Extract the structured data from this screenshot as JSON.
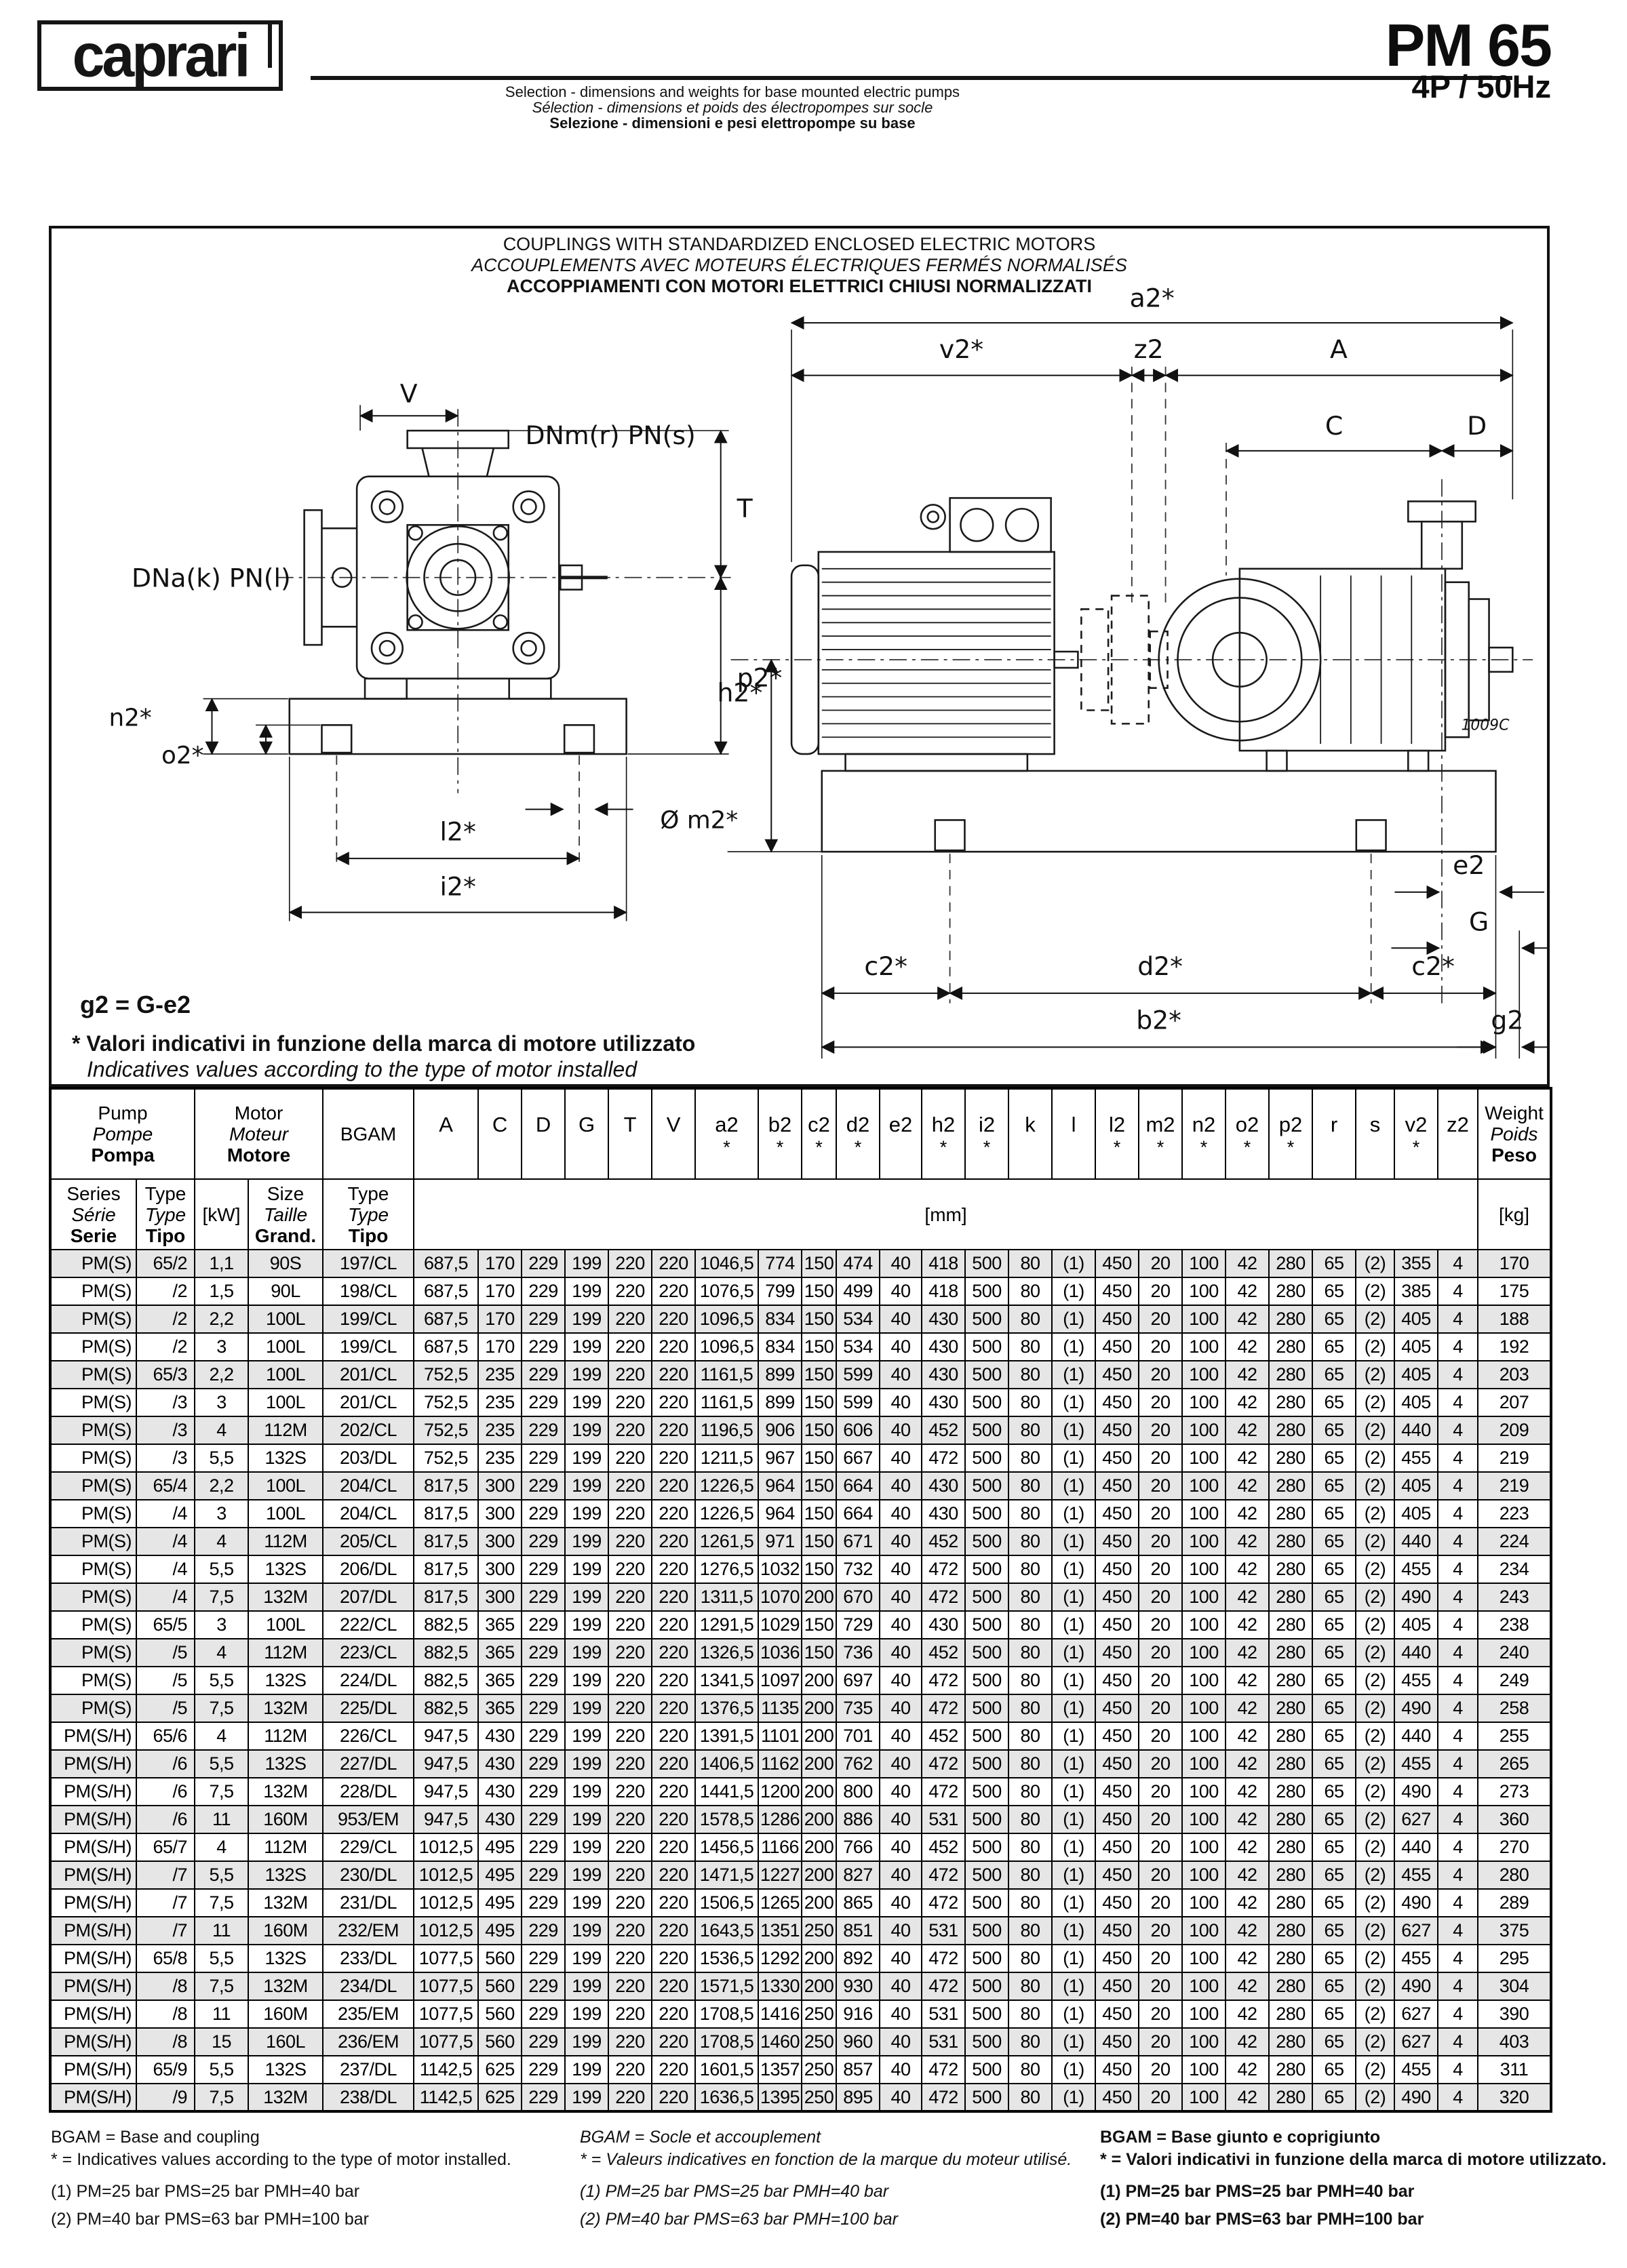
{
  "header": {
    "logo": "caprari",
    "subtitle_lines": {
      "en": "Selection - dimensions and weights for base mounted electric pumps",
      "fr": "Sélection - dimensions et poids des électropompes sur socle",
      "it": "Selezione - dimensioni e pesi elettropompe su base"
    },
    "model": "PM 65",
    "spec": "4P / 50Hz"
  },
  "diagram": {
    "title_lines": {
      "en": "COUPLINGS WITH STANDARDIZED ENCLOSED ELECTRIC MOTORS",
      "fr": "ACCOUPLEMENTS AVEC MOTEURS ÉLECTRIQUES FERMÉS NORMALISÉS",
      "it": "ACCOPPIAMENTI CON MOTORI ELETTRICI CHIUSI NORMALIZZATI"
    },
    "note_g2": "g2 = G-e2",
    "note_star_it": "* Valori indicativi in funzione della marca di motore utilizzato",
    "note_star_en": "Indicatives values according to the type of motor installed",
    "labels": {
      "v": "V",
      "dnm": "DNm(r) PN(s)",
      "t": "T",
      "dna": "DNa(k) PN(l)",
      "p2": "p2*",
      "n2": "n2*",
      "o2": "o2*",
      "m2": "Ø m2*",
      "l2": "l2*",
      "i2": "i2*",
      "a2": "a2*",
      "v2": "v2*",
      "z2": "z2",
      "A": "A",
      "C": "C",
      "D": "D",
      "h2": "h2*",
      "e2": "e2",
      "G": "G",
      "c2_left": "c2*",
      "d2": "d2*",
      "c2_right": "c2*",
      "b2": "b2*",
      "g2": "g2",
      "ref_code": "1009C"
    }
  },
  "table": {
    "groups": {
      "pump": [
        "Pump",
        "Pompe",
        "Pompa"
      ],
      "motor": [
        "Motor",
        "Moteur",
        "Motore"
      ],
      "bgam": "BGAM",
      "weight": [
        "Weight",
        "Poids",
        "Peso"
      ]
    },
    "subheaders": {
      "series": [
        "Series",
        "Série",
        "Serie"
      ],
      "type": [
        "Type",
        "Type",
        "Tipo"
      ],
      "kw": "[kW]",
      "size": [
        "Size",
        "Taille",
        "Grand."
      ],
      "bgam_type": [
        "Type",
        "Type",
        "Tipo"
      ],
      "mm": "[mm]",
      "kg": "[kg]"
    },
    "dim_columns": [
      {
        "label": "A",
        "star": false
      },
      {
        "label": "C",
        "star": false
      },
      {
        "label": "D",
        "star": false
      },
      {
        "label": "G",
        "star": false
      },
      {
        "label": "T",
        "star": false
      },
      {
        "label": "V",
        "star": false
      },
      {
        "label": "a2",
        "star": true
      },
      {
        "label": "b2",
        "star": true
      },
      {
        "label": "c2",
        "star": true
      },
      {
        "label": "d2",
        "star": true
      },
      {
        "label": "e2",
        "star": false
      },
      {
        "label": "h2",
        "star": true
      },
      {
        "label": "i2",
        "star": true
      },
      {
        "label": "k",
        "star": false
      },
      {
        "label": "l",
        "star": false
      },
      {
        "label": "l2",
        "star": true
      },
      {
        "label": "m2",
        "star": true
      },
      {
        "label": "n2",
        "star": true
      },
      {
        "label": "o2",
        "star": true
      },
      {
        "label": "p2",
        "star": true
      },
      {
        "label": "r",
        "star": false
      },
      {
        "label": "s",
        "star": false
      },
      {
        "label": "v2",
        "star": true
      },
      {
        "label": "z2",
        "star": false
      }
    ],
    "rows": [
      [
        "PM(S)",
        "65/2",
        "1,1",
        "90S",
        "197/CL",
        "687,5",
        "170",
        "229",
        "199",
        "220",
        "220",
        "1046,5",
        "774",
        "150",
        "474",
        "40",
        "418",
        "500",
        "80",
        "(1)",
        "450",
        "20",
        "100",
        "42",
        "280",
        "65",
        "(2)",
        "355",
        "4",
        "170"
      ],
      [
        "PM(S)",
        "/2",
        "1,5",
        "90L",
        "198/CL",
        "687,5",
        "170",
        "229",
        "199",
        "220",
        "220",
        "1076,5",
        "799",
        "150",
        "499",
        "40",
        "418",
        "500",
        "80",
        "(1)",
        "450",
        "20",
        "100",
        "42",
        "280",
        "65",
        "(2)",
        "385",
        "4",
        "175"
      ],
      [
        "PM(S)",
        "/2",
        "2,2",
        "100L",
        "199/CL",
        "687,5",
        "170",
        "229",
        "199",
        "220",
        "220",
        "1096,5",
        "834",
        "150",
        "534",
        "40",
        "430",
        "500",
        "80",
        "(1)",
        "450",
        "20",
        "100",
        "42",
        "280",
        "65",
        "(2)",
        "405",
        "4",
        "188"
      ],
      [
        "PM(S)",
        "/2",
        "3",
        "100L",
        "199/CL",
        "687,5",
        "170",
        "229",
        "199",
        "220",
        "220",
        "1096,5",
        "834",
        "150",
        "534",
        "40",
        "430",
        "500",
        "80",
        "(1)",
        "450",
        "20",
        "100",
        "42",
        "280",
        "65",
        "(2)",
        "405",
        "4",
        "192"
      ],
      [
        "PM(S)",
        "65/3",
        "2,2",
        "100L",
        "201/CL",
        "752,5",
        "235",
        "229",
        "199",
        "220",
        "220",
        "1161,5",
        "899",
        "150",
        "599",
        "40",
        "430",
        "500",
        "80",
        "(1)",
        "450",
        "20",
        "100",
        "42",
        "280",
        "65",
        "(2)",
        "405",
        "4",
        "203"
      ],
      [
        "PM(S)",
        "/3",
        "3",
        "100L",
        "201/CL",
        "752,5",
        "235",
        "229",
        "199",
        "220",
        "220",
        "1161,5",
        "899",
        "150",
        "599",
        "40",
        "430",
        "500",
        "80",
        "(1)",
        "450",
        "20",
        "100",
        "42",
        "280",
        "65",
        "(2)",
        "405",
        "4",
        "207"
      ],
      [
        "PM(S)",
        "/3",
        "4",
        "112M",
        "202/CL",
        "752,5",
        "235",
        "229",
        "199",
        "220",
        "220",
        "1196,5",
        "906",
        "150",
        "606",
        "40",
        "452",
        "500",
        "80",
        "(1)",
        "450",
        "20",
        "100",
        "42",
        "280",
        "65",
        "(2)",
        "440",
        "4",
        "209"
      ],
      [
        "PM(S)",
        "/3",
        "5,5",
        "132S",
        "203/DL",
        "752,5",
        "235",
        "229",
        "199",
        "220",
        "220",
        "1211,5",
        "967",
        "150",
        "667",
        "40",
        "472",
        "500",
        "80",
        "(1)",
        "450",
        "20",
        "100",
        "42",
        "280",
        "65",
        "(2)",
        "455",
        "4",
        "219"
      ],
      [
        "PM(S)",
        "65/4",
        "2,2",
        "100L",
        "204/CL",
        "817,5",
        "300",
        "229",
        "199",
        "220",
        "220",
        "1226,5",
        "964",
        "150",
        "664",
        "40",
        "430",
        "500",
        "80",
        "(1)",
        "450",
        "20",
        "100",
        "42",
        "280",
        "65",
        "(2)",
        "405",
        "4",
        "219"
      ],
      [
        "PM(S)",
        "/4",
        "3",
        "100L",
        "204/CL",
        "817,5",
        "300",
        "229",
        "199",
        "220",
        "220",
        "1226,5",
        "964",
        "150",
        "664",
        "40",
        "430",
        "500",
        "80",
        "(1)",
        "450",
        "20",
        "100",
        "42",
        "280",
        "65",
        "(2)",
        "405",
        "4",
        "223"
      ],
      [
        "PM(S)",
        "/4",
        "4",
        "112M",
        "205/CL",
        "817,5",
        "300",
        "229",
        "199",
        "220",
        "220",
        "1261,5",
        "971",
        "150",
        "671",
        "40",
        "452",
        "500",
        "80",
        "(1)",
        "450",
        "20",
        "100",
        "42",
        "280",
        "65",
        "(2)",
        "440",
        "4",
        "224"
      ],
      [
        "PM(S)",
        "/4",
        "5,5",
        "132S",
        "206/DL",
        "817,5",
        "300",
        "229",
        "199",
        "220",
        "220",
        "1276,5",
        "1032",
        "150",
        "732",
        "40",
        "472",
        "500",
        "80",
        "(1)",
        "450",
        "20",
        "100",
        "42",
        "280",
        "65",
        "(2)",
        "455",
        "4",
        "234"
      ],
      [
        "PM(S)",
        "/4",
        "7,5",
        "132M",
        "207/DL",
        "817,5",
        "300",
        "229",
        "199",
        "220",
        "220",
        "1311,5",
        "1070",
        "200",
        "670",
        "40",
        "472",
        "500",
        "80",
        "(1)",
        "450",
        "20",
        "100",
        "42",
        "280",
        "65",
        "(2)",
        "490",
        "4",
        "243"
      ],
      [
        "PM(S)",
        "65/5",
        "3",
        "100L",
        "222/CL",
        "882,5",
        "365",
        "229",
        "199",
        "220",
        "220",
        "1291,5",
        "1029",
        "150",
        "729",
        "40",
        "430",
        "500",
        "80",
        "(1)",
        "450",
        "20",
        "100",
        "42",
        "280",
        "65",
        "(2)",
        "405",
        "4",
        "238"
      ],
      [
        "PM(S)",
        "/5",
        "4",
        "112M",
        "223/CL",
        "882,5",
        "365",
        "229",
        "199",
        "220",
        "220",
        "1326,5",
        "1036",
        "150",
        "736",
        "40",
        "452",
        "500",
        "80",
        "(1)",
        "450",
        "20",
        "100",
        "42",
        "280",
        "65",
        "(2)",
        "440",
        "4",
        "240"
      ],
      [
        "PM(S)",
        "/5",
        "5,5",
        "132S",
        "224/DL",
        "882,5",
        "365",
        "229",
        "199",
        "220",
        "220",
        "1341,5",
        "1097",
        "200",
        "697",
        "40",
        "472",
        "500",
        "80",
        "(1)",
        "450",
        "20",
        "100",
        "42",
        "280",
        "65",
        "(2)",
        "455",
        "4",
        "249"
      ],
      [
        "PM(S)",
        "/5",
        "7,5",
        "132M",
        "225/DL",
        "882,5",
        "365",
        "229",
        "199",
        "220",
        "220",
        "1376,5",
        "1135",
        "200",
        "735",
        "40",
        "472",
        "500",
        "80",
        "(1)",
        "450",
        "20",
        "100",
        "42",
        "280",
        "65",
        "(2)",
        "490",
        "4",
        "258"
      ],
      [
        "PM(S/H)",
        "65/6",
        "4",
        "112M",
        "226/CL",
        "947,5",
        "430",
        "229",
        "199",
        "220",
        "220",
        "1391,5",
        "1101",
        "200",
        "701",
        "40",
        "452",
        "500",
        "80",
        "(1)",
        "450",
        "20",
        "100",
        "42",
        "280",
        "65",
        "(2)",
        "440",
        "4",
        "255"
      ],
      [
        "PM(S/H)",
        "/6",
        "5,5",
        "132S",
        "227/DL",
        "947,5",
        "430",
        "229",
        "199",
        "220",
        "220",
        "1406,5",
        "1162",
        "200",
        "762",
        "40",
        "472",
        "500",
        "80",
        "(1)",
        "450",
        "20",
        "100",
        "42",
        "280",
        "65",
        "(2)",
        "455",
        "4",
        "265"
      ],
      [
        "PM(S/H)",
        "/6",
        "7,5",
        "132M",
        "228/DL",
        "947,5",
        "430",
        "229",
        "199",
        "220",
        "220",
        "1441,5",
        "1200",
        "200",
        "800",
        "40",
        "472",
        "500",
        "80",
        "(1)",
        "450",
        "20",
        "100",
        "42",
        "280",
        "65",
        "(2)",
        "490",
        "4",
        "273"
      ],
      [
        "PM(S/H)",
        "/6",
        "11",
        "160M",
        "953/EM",
        "947,5",
        "430",
        "229",
        "199",
        "220",
        "220",
        "1578,5",
        "1286",
        "200",
        "886",
        "40",
        "531",
        "500",
        "80",
        "(1)",
        "450",
        "20",
        "100",
        "42",
        "280",
        "65",
        "(2)",
        "627",
        "4",
        "360"
      ],
      [
        "PM(S/H)",
        "65/7",
        "4",
        "112M",
        "229/CL",
        "1012,5",
        "495",
        "229",
        "199",
        "220",
        "220",
        "1456,5",
        "1166",
        "200",
        "766",
        "40",
        "452",
        "500",
        "80",
        "(1)",
        "450",
        "20",
        "100",
        "42",
        "280",
        "65",
        "(2)",
        "440",
        "4",
        "270"
      ],
      [
        "PM(S/H)",
        "/7",
        "5,5",
        "132S",
        "230/DL",
        "1012,5",
        "495",
        "229",
        "199",
        "220",
        "220",
        "1471,5",
        "1227",
        "200",
        "827",
        "40",
        "472",
        "500",
        "80",
        "(1)",
        "450",
        "20",
        "100",
        "42",
        "280",
        "65",
        "(2)",
        "455",
        "4",
        "280"
      ],
      [
        "PM(S/H)",
        "/7",
        "7,5",
        "132M",
        "231/DL",
        "1012,5",
        "495",
        "229",
        "199",
        "220",
        "220",
        "1506,5",
        "1265",
        "200",
        "865",
        "40",
        "472",
        "500",
        "80",
        "(1)",
        "450",
        "20",
        "100",
        "42",
        "280",
        "65",
        "(2)",
        "490",
        "4",
        "289"
      ],
      [
        "PM(S/H)",
        "/7",
        "11",
        "160M",
        "232/EM",
        "1012,5",
        "495",
        "229",
        "199",
        "220",
        "220",
        "1643,5",
        "1351",
        "250",
        "851",
        "40",
        "531",
        "500",
        "80",
        "(1)",
        "450",
        "20",
        "100",
        "42",
        "280",
        "65",
        "(2)",
        "627",
        "4",
        "375"
      ],
      [
        "PM(S/H)",
        "65/8",
        "5,5",
        "132S",
        "233/DL",
        "1077,5",
        "560",
        "229",
        "199",
        "220",
        "220",
        "1536,5",
        "1292",
        "200",
        "892",
        "40",
        "472",
        "500",
        "80",
        "(1)",
        "450",
        "20",
        "100",
        "42",
        "280",
        "65",
        "(2)",
        "455",
        "4",
        "295"
      ],
      [
        "PM(S/H)",
        "/8",
        "7,5",
        "132M",
        "234/DL",
        "1077,5",
        "560",
        "229",
        "199",
        "220",
        "220",
        "1571,5",
        "1330",
        "200",
        "930",
        "40",
        "472",
        "500",
        "80",
        "(1)",
        "450",
        "20",
        "100",
        "42",
        "280",
        "65",
        "(2)",
        "490",
        "4",
        "304"
      ],
      [
        "PM(S/H)",
        "/8",
        "11",
        "160M",
        "235/EM",
        "1077,5",
        "560",
        "229",
        "199",
        "220",
        "220",
        "1708,5",
        "1416",
        "250",
        "916",
        "40",
        "531",
        "500",
        "80",
        "(1)",
        "450",
        "20",
        "100",
        "42",
        "280",
        "65",
        "(2)",
        "627",
        "4",
        "390"
      ],
      [
        "PM(S/H)",
        "/8",
        "15",
        "160L",
        "236/EM",
        "1077,5",
        "560",
        "229",
        "199",
        "220",
        "220",
        "1708,5",
        "1460",
        "250",
        "960",
        "40",
        "531",
        "500",
        "80",
        "(1)",
        "450",
        "20",
        "100",
        "42",
        "280",
        "65",
        "(2)",
        "627",
        "4",
        "403"
      ],
      [
        "PM(S/H)",
        "65/9",
        "5,5",
        "132S",
        "237/DL",
        "1142,5",
        "625",
        "229",
        "199",
        "220",
        "220",
        "1601,5",
        "1357",
        "250",
        "857",
        "40",
        "472",
        "500",
        "80",
        "(1)",
        "450",
        "20",
        "100",
        "42",
        "280",
        "65",
        "(2)",
        "455",
        "4",
        "311"
      ],
      [
        "PM(S/H)",
        "/9",
        "7,5",
        "132M",
        "238/DL",
        "1142,5",
        "625",
        "229",
        "199",
        "220",
        "220",
        "1636,5",
        "1395",
        "250",
        "895",
        "40",
        "472",
        "500",
        "80",
        "(1)",
        "450",
        "20",
        "100",
        "42",
        "280",
        "65",
        "(2)",
        "490",
        "4",
        "320"
      ]
    ]
  },
  "footnotes": {
    "en": [
      "BGAM = Base and coupling",
      "* = Indicatives values according to the type of motor installed.",
      "(1) PM=25 bar  PMS=25 bar  PMH=40 bar",
      "(2) PM=40 bar  PMS=63 bar  PMH=100 bar"
    ],
    "fr": [
      "BGAM = Socle et accouplement",
      "* = Valeurs indicatives en fonction de la marque du moteur utilisé.",
      "(1) PM=25 bar  PMS=25 bar  PMH=40 bar",
      "(2) PM=40 bar  PMS=63 bar  PMH=100 bar"
    ],
    "it": [
      "BGAM = Base giunto e coprigiunto",
      "* = Valori indicativi in funzione della marca di motore utilizzato.",
      "(1) PM=25 bar  PMS=25 bar  PMH=40 bar",
      "(2) PM=40 bar  PMS=63 bar  PMH=100 bar"
    ]
  }
}
